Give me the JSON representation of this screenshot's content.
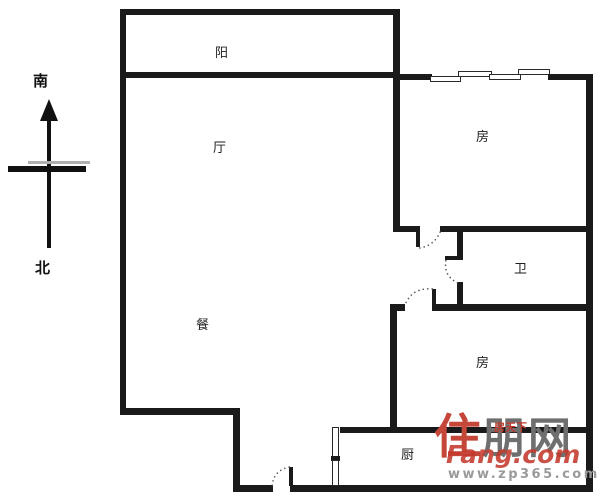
{
  "compass": {
    "south_label": "南",
    "north_label": "北"
  },
  "rooms": {
    "balcony": {
      "label": "阳"
    },
    "living": {
      "label": "厅"
    },
    "dining": {
      "label": "餐"
    },
    "bedroom1": {
      "label": "房"
    },
    "bathroom": {
      "label": "卫"
    },
    "bedroom2": {
      "label": "房"
    },
    "kitchen": {
      "label": "厨"
    }
  },
  "watermark": {
    "brand_first_char": "住",
    "brand_rest": "朋网",
    "overlay_small": "房天下",
    "overlay_script": "Fang.com",
    "url": "www.zp365.com",
    "accent_color": "#c5473a",
    "gray_color": "#9a9a9a"
  },
  "colors": {
    "wall": "#1a1a1a",
    "background": "#ffffff"
  }
}
